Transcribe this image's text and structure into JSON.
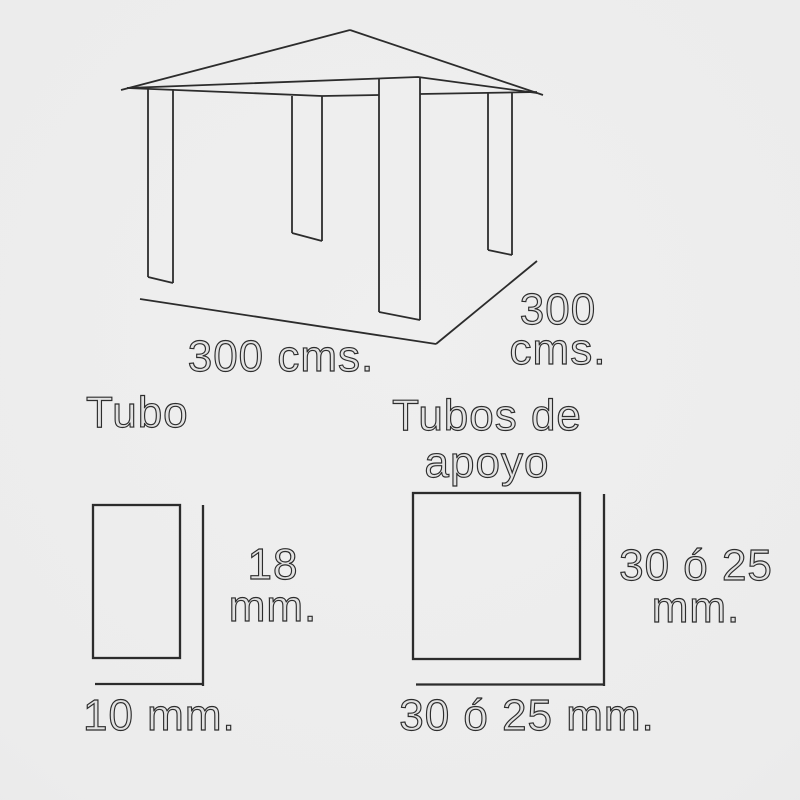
{
  "meta": {
    "background_color": "#ececec",
    "line_color": "#2c2c2c",
    "drawing_type": "gazebo structure dimensions"
  },
  "gazebo": {
    "front_dimension": "300 cms.",
    "side_dimension": {
      "line1": "300",
      "line2": "cms."
    }
  },
  "tube_section": {
    "title": "Tubo",
    "height": {
      "line1": "18",
      "line2": "mm."
    },
    "width": "10 mm."
  },
  "support_tube_section": {
    "title": {
      "line1": "Tubos de",
      "line2": "apoyo"
    },
    "height": {
      "line1": "30 ó 25",
      "line2": "mm."
    },
    "width": "30 ó 25 mm."
  }
}
